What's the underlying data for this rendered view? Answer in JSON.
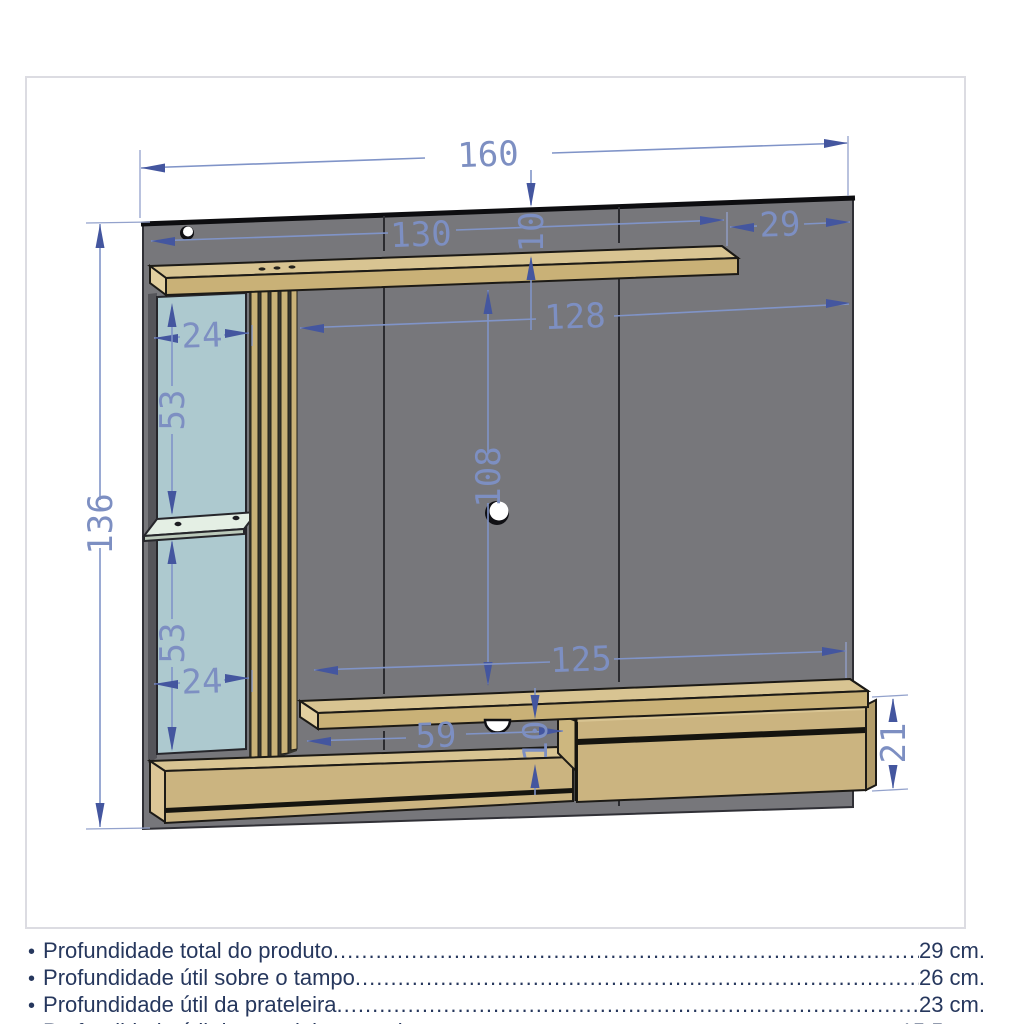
{
  "diagram": {
    "dimensions": {
      "total_width": "160",
      "shelf_width": "130",
      "shelf_right_offset": "29",
      "top_to_shelf_gap": "10",
      "clearance_width": "128",
      "side_niche_width_top": "24",
      "side_niche_upper_height": "53",
      "total_height": "136",
      "center_clearance_height": "108",
      "side_niche_lower_height": "53",
      "side_niche_width_bottom": "24",
      "base_clearance_width": "125",
      "bottom_niche_width": "59",
      "bottom_niche_height": "10",
      "base_unit_height": "21"
    },
    "colors": {
      "panel_gray": "#77777b",
      "wood_front": "#c9b177",
      "wood_top": "#d8c492",
      "glass_blue": "#adc9cf",
      "glass_shelf": "#e4efe4",
      "dimension_blue": "#8094c8",
      "arrow_blue": "#44569f",
      "spec_text_navy": "#26375d"
    }
  },
  "specs": {
    "leader": "................................................................................................................................................................................................................................................................",
    "items": [
      {
        "bullet": "•",
        "label": "Profundidade total do produto",
        "value": "29 cm."
      },
      {
        "bullet": "•",
        "label": "Profundidade útil sobre o tampo ",
        "value": "26 cm."
      },
      {
        "bullet": "•",
        "label": "Profundidade útil da prateleira ",
        "value": "23 cm."
      },
      {
        "bullet": "•",
        "label": "Profundidade útil da prateleira superior ",
        "value": "15,5 cm."
      }
    ]
  }
}
